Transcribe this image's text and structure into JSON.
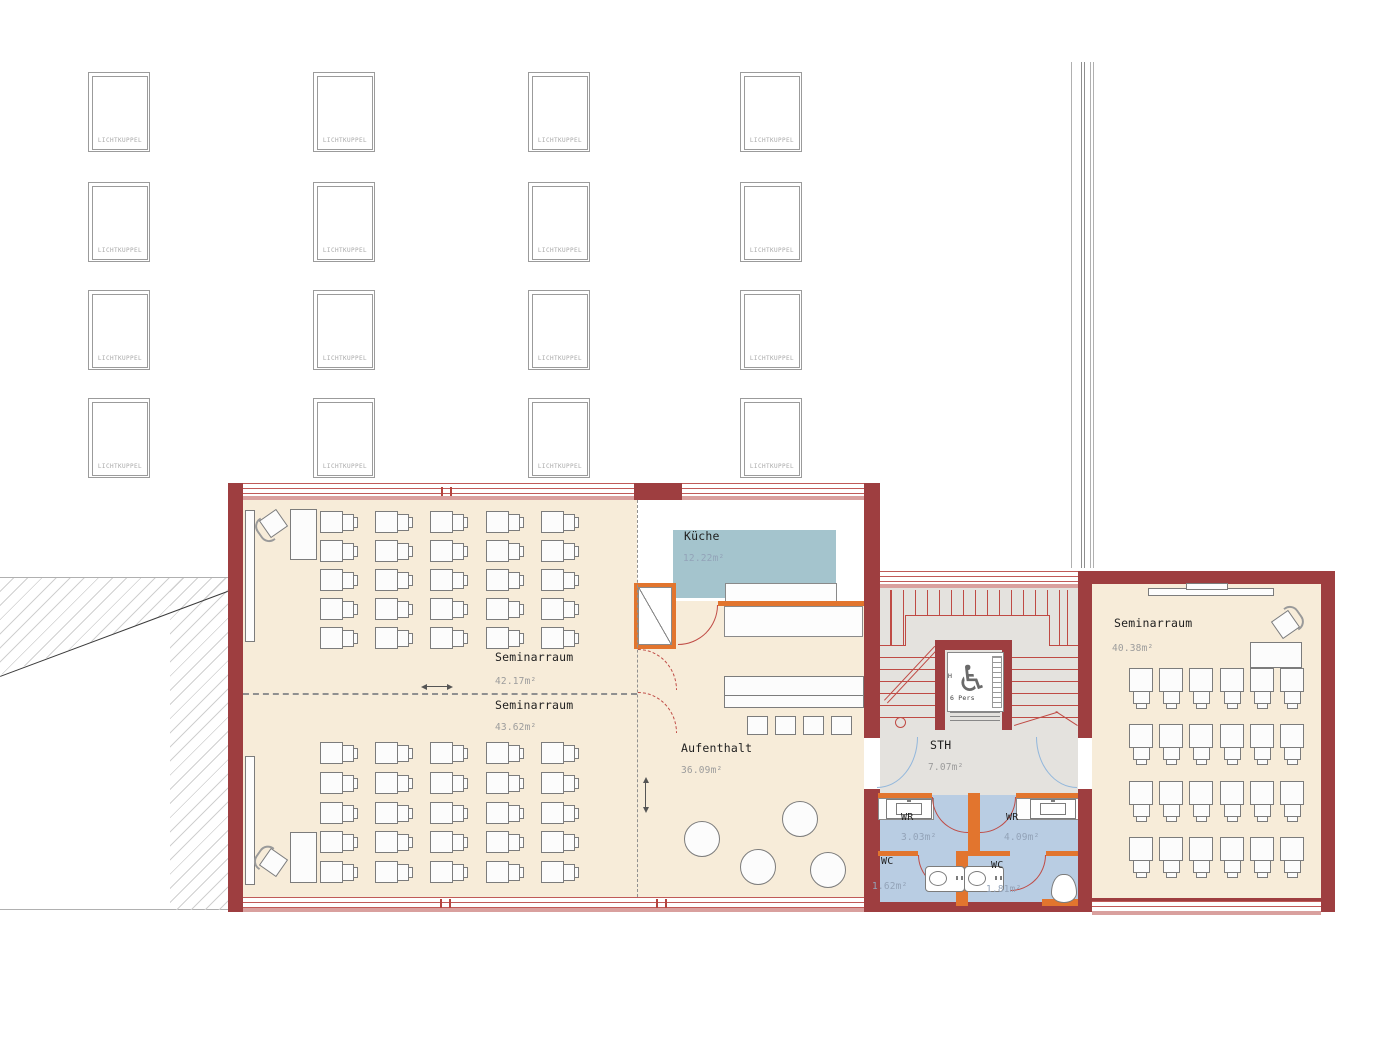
{
  "meta": {
    "drawing_type": "floor plan",
    "language": "de"
  },
  "colors": {
    "wall_red": "#9e3e40",
    "partition_orange": "#e2752e",
    "line_red": "#bf4a44",
    "floor_cream": "#f7ecd9",
    "floor_gray": "#e4e2de",
    "kitchen_blue": "#a4c4cd",
    "wet_room_blue": "#b9cde3",
    "door_arc_blue": "#92b7dc",
    "label_black": "#1f1f1f",
    "label_gray": "#9c9c9c"
  },
  "skylights": {
    "label": "LICHTKUPPEL",
    "rows": 4,
    "cols": 4,
    "count": 16
  },
  "rooms": {
    "seminar1": {
      "name": "Seminarraum",
      "area": "42.17m²",
      "desks": {
        "rows": 5,
        "cols": 5
      }
    },
    "seminar2": {
      "name": "Seminarraum",
      "area": "43.62m²",
      "desks": {
        "rows": 5,
        "cols": 5
      }
    },
    "kitchen": {
      "name": "Küche",
      "area": "12.22m²"
    },
    "lounge": {
      "name": "Aufenthalt",
      "area": "36.09m²"
    },
    "stairhall": {
      "name": "STH",
      "area": "7.07m²"
    },
    "wr_left": {
      "name": "WR",
      "area": "3.03m²"
    },
    "wr_right": {
      "name": "WR",
      "area": "4.09m²"
    },
    "wc_left": {
      "name": "WC",
      "area": "1.62m²"
    },
    "wc_right": {
      "name": "WC",
      "area": "1.81m²"
    },
    "seminar3": {
      "name": "Seminarraum",
      "area": "40.38m²",
      "desks": {
        "rows": 4,
        "cols": 6
      }
    }
  },
  "elevator": {
    "capacity_label": "6 Pers",
    "side_label": "H",
    "wheelchair_icon": "♿"
  }
}
